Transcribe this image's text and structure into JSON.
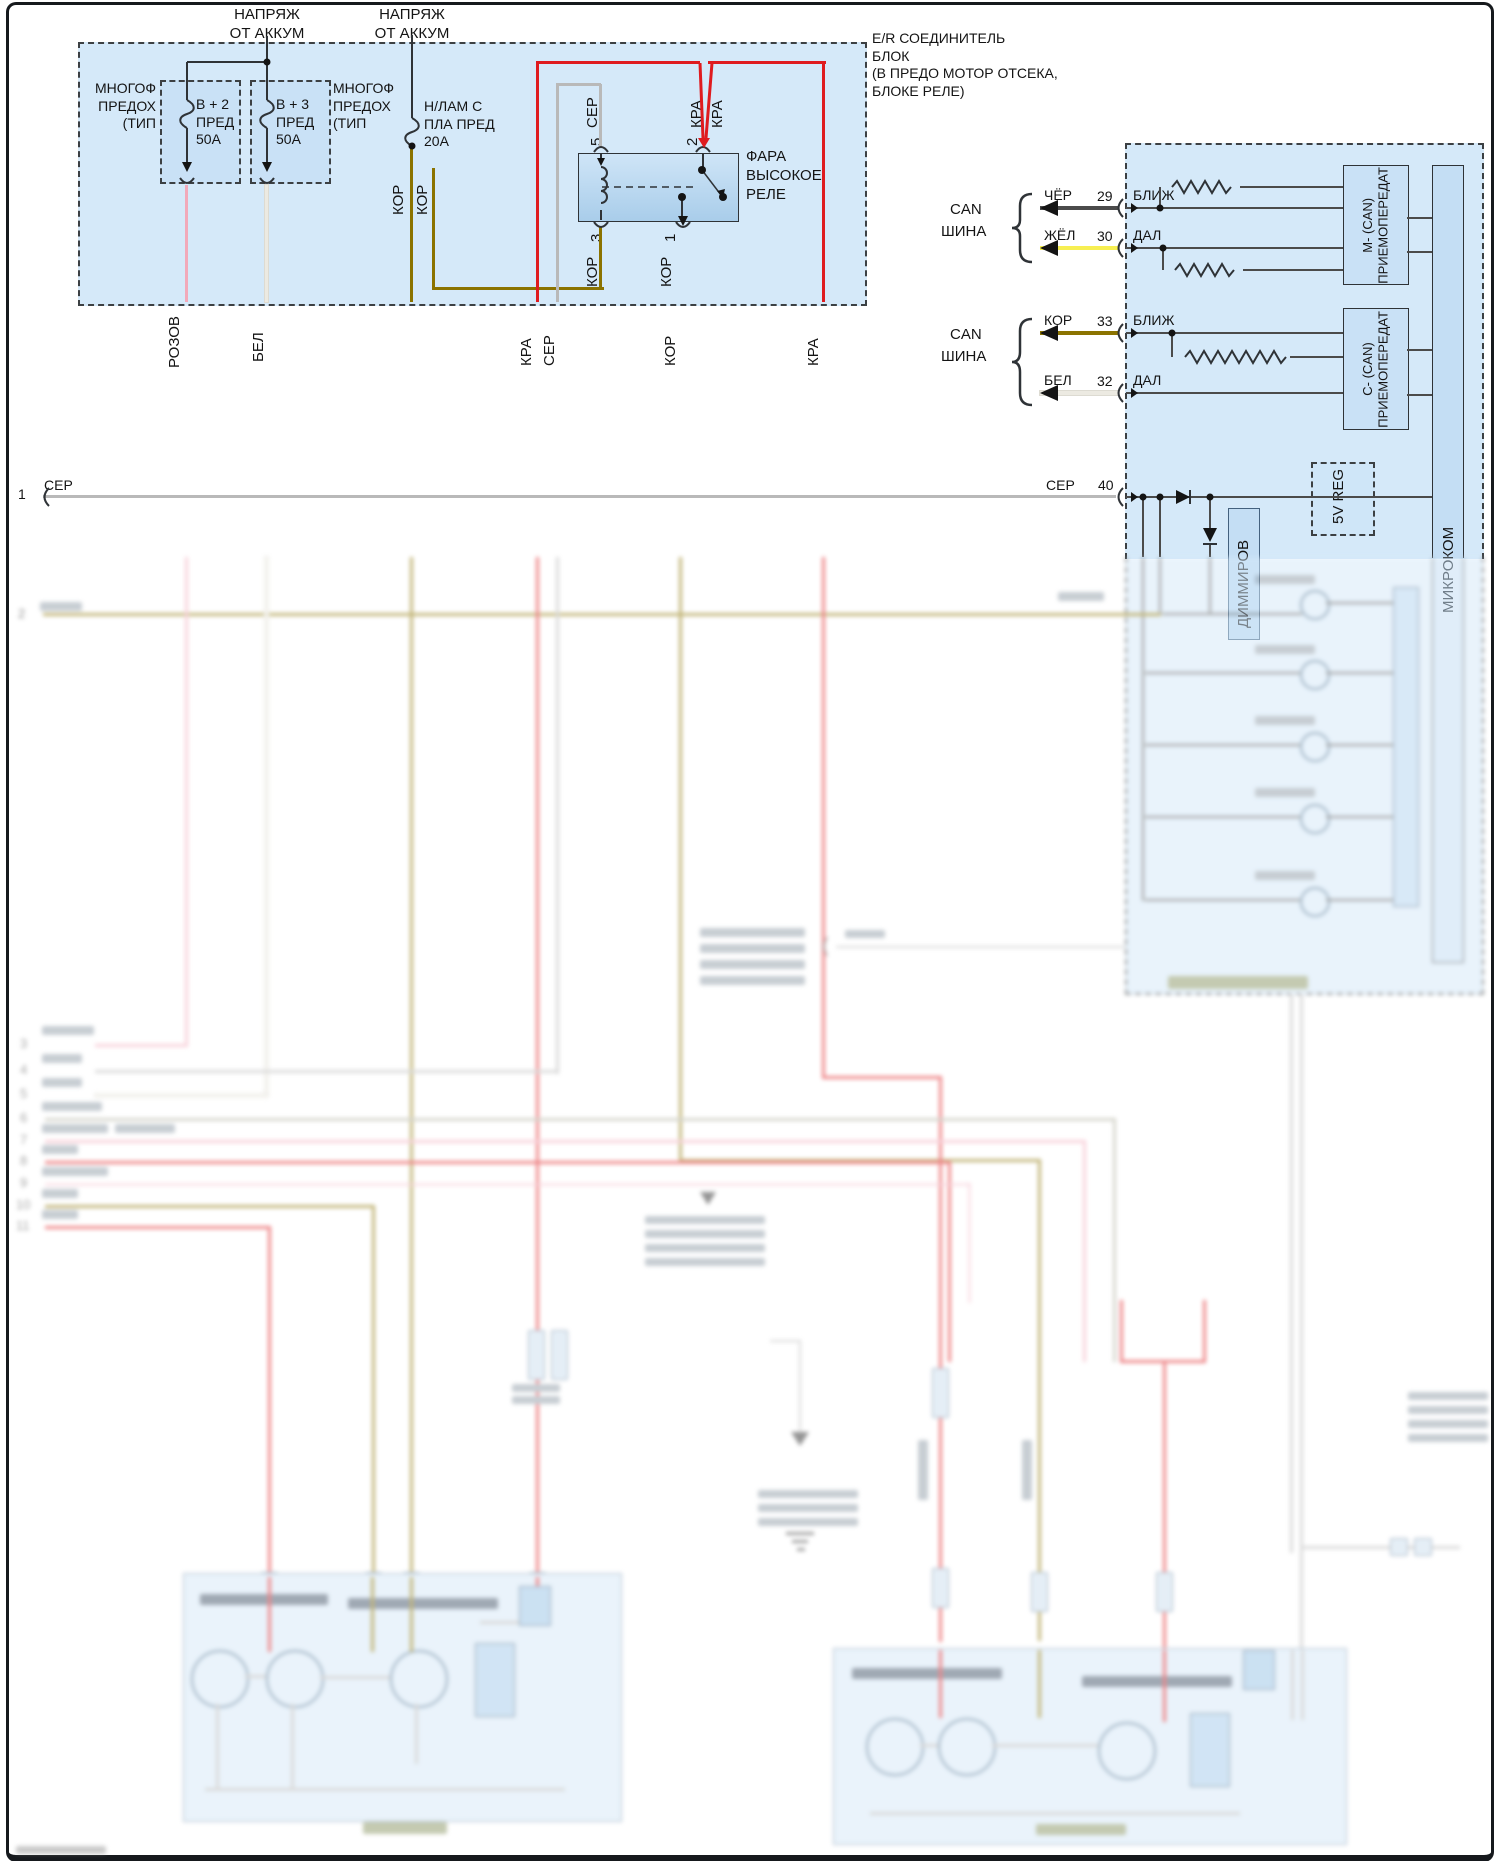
{
  "colors": {
    "panel_blue": "#d5e9f9",
    "box_blue": "#c9e1f6",
    "relay_blue": "#bcd8f1",
    "wire_red": "#df1b1f",
    "wire_pink": "#f2a9ba",
    "wire_white": "#eceae2",
    "wire_olive": "#8b7300",
    "wire_gray": "#b9b9b9",
    "wire_black": "#4b4b4b",
    "wire_yellow": "#f7ef52",
    "line_dark": "#2f3337"
  },
  "feeds": {
    "line1": "НАПРЯЖ",
    "line2": "ОТ АККУМ"
  },
  "er_block": {
    "l1": "E/R СОЕДИНИТЕЛЬ",
    "l2": "БЛОК",
    "l3": "(В ПРЕДО МОТОР ОТСЕКА,",
    "l4": "БЛОКЕ РЕЛЕ)"
  },
  "fuses": {
    "group_l1": "МНОГОФ",
    "group_l2": "ПРЕДОХ",
    "group_l3": "(ТИП",
    "fuse1_l1": "В + 2",
    "fuse1_l2": "ПРЕД",
    "fuse1_l3": "50А",
    "fuse2_l1": "В + 3",
    "fuse2_l2": "ПРЕД",
    "fuse2_l3": "50А",
    "fuse3_l1": "Н/ЛАМ С",
    "fuse3_l2": "ПЛА ПРЕД",
    "fuse3_l3": "20А",
    "fuse3_w1": "КОР",
    "fuse3_w2": "КОР"
  },
  "relay": {
    "n1": "ФАРА",
    "n2": "ВЫСОКОЕ",
    "n3": "РЕЛЕ",
    "pin5": "5",
    "pin2": "2",
    "pin3": "3",
    "pin1": "1",
    "w5": "СЕР",
    "w2a": "КРА",
    "w2b": "КРА",
    "w3": "КОР",
    "w1": "КОР"
  },
  "drop_labels": {
    "pink": "РОЗОВ",
    "white": "БЕЛ",
    "red1": "КРА",
    "gray": "СЕР",
    "olive": "КОР",
    "red2": "КРА"
  },
  "rows": {
    "n1": "1",
    "w1": "СЕР",
    "n2": "2",
    "n3": "3",
    "n4": "4",
    "n5": "5",
    "n6": "6",
    "n7": "7",
    "n8": "8",
    "n9": "9",
    "n10": "10",
    "n11": "11"
  },
  "can": {
    "bus_l1": "CAN",
    "bus_l2": "ШИНА",
    "l29_wire": "ЧЁР",
    "l29_pin": "29",
    "l29_sig": "БЛИЖ",
    "l30_wire": "ЖЁЛ",
    "l30_pin": "30",
    "l30_sig": "ДАЛ",
    "l33_wire": "КОР",
    "l33_pin": "33",
    "l33_sig": "БЛИЖ",
    "l32_wire": "БЕЛ",
    "l32_pin": "32",
    "l32_sig": "ДАЛ",
    "m_box_l1": "M- (CAN)",
    "m_box_l2": "ПРИЕМОПЕРЕДАТ",
    "c_box_l1": "C- (CAN)",
    "c_box_l2": "ПРИЕМОПЕРЕДАТ"
  },
  "module": {
    "pin40_wire": "СЕР",
    "pin40": "40",
    "regulator": "5V REG",
    "dimmer": "ДИММИРОВ",
    "mcu": "МИКРОКОМ"
  }
}
